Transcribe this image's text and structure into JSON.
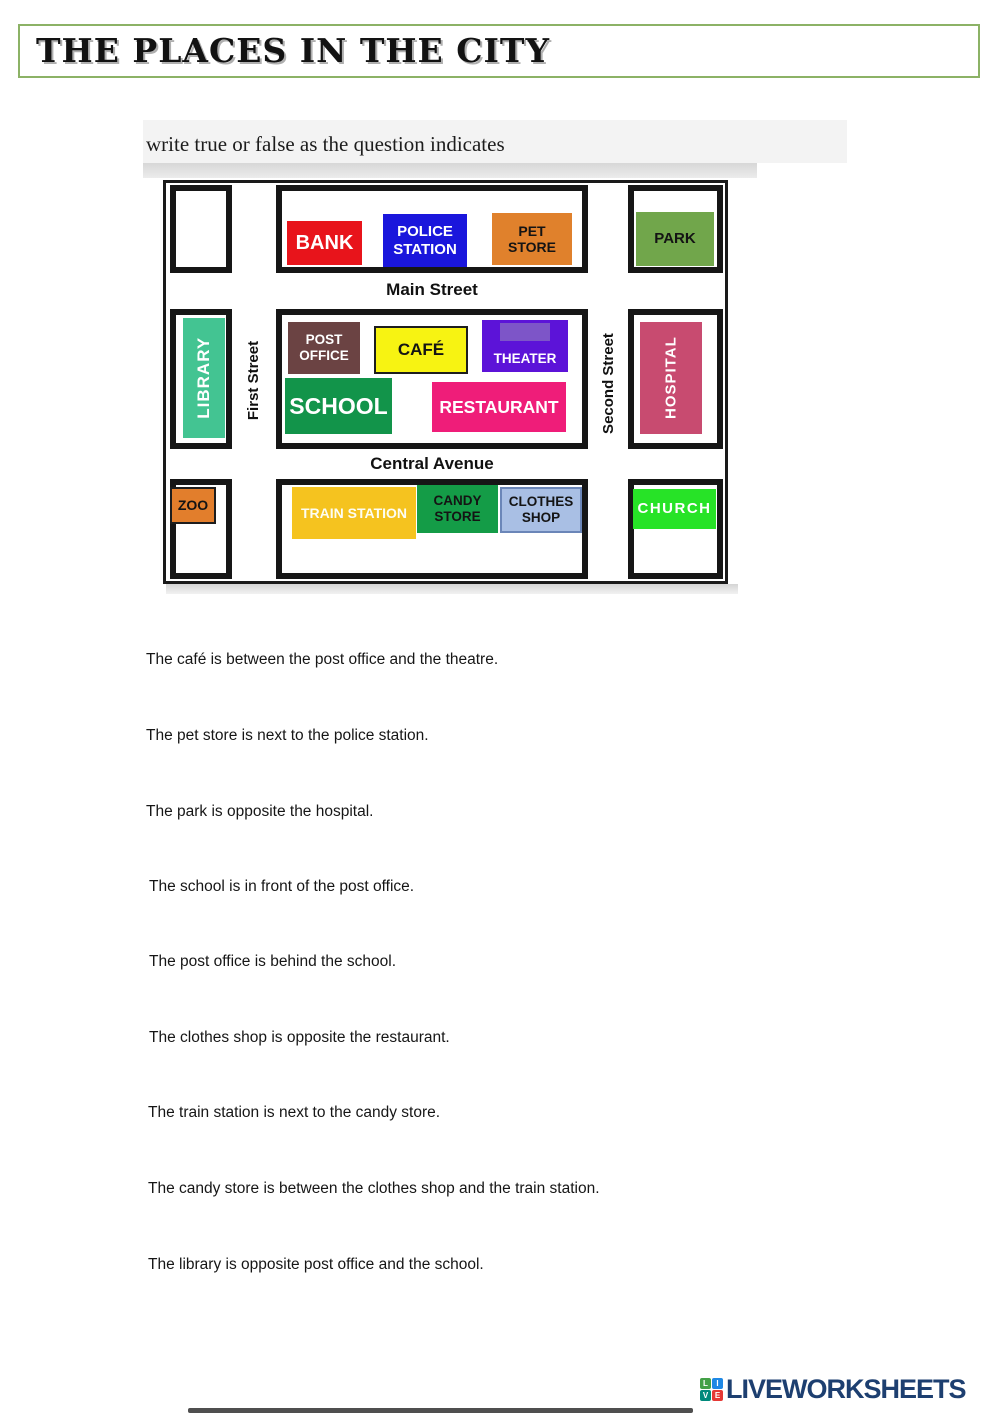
{
  "page": {
    "title": "THE PLACES IN THE CITY",
    "instruction": "write true or false as the question indicates"
  },
  "map": {
    "streets": {
      "main": "Main Street",
      "central": "Central Avenue",
      "first": "First Street",
      "second": "Second Street"
    },
    "buildings": {
      "bank": {
        "label": "BANK",
        "color": "#e8141b"
      },
      "police_station": {
        "label": "POLICE STATION",
        "color": "#1a16dc"
      },
      "pet_store": {
        "label": "PET STORE",
        "color": "#e0812c"
      },
      "park": {
        "label": "PARK",
        "color": "#71a64b"
      },
      "library": {
        "label": "LIBRARY",
        "color": "#43c492"
      },
      "post_office": {
        "label": "POST OFFICE",
        "color": "#6b4343"
      },
      "cafe": {
        "label": "CAFÉ",
        "color": "#f7f312"
      },
      "theater": {
        "label": "THEATER",
        "color": "#5c13d8",
        "decor_color": "#7d55c8"
      },
      "school": {
        "label": "SCHOOL",
        "color": "#12944a"
      },
      "restaurant": {
        "label": "RESTAURANT",
        "color": "#ef1d79"
      },
      "hospital": {
        "label": "HOSPITAL",
        "color": "#c84b70"
      },
      "zoo": {
        "label": "ZOO",
        "color": "#e27e2c"
      },
      "train_station": {
        "label": "TRAIN STATION",
        "color": "#f5c31f"
      },
      "candy_store": {
        "label": "CANDY STORE",
        "color": "#149c47"
      },
      "clothes_shop": {
        "label": "CLOTHES SHOP",
        "color": "#a9bfe4"
      },
      "church": {
        "label": "CHURCH",
        "color": "#27e327"
      }
    }
  },
  "questions": [
    "The café is between the post office and the theatre.",
    "The pet store is next to the police station.",
    "The park is opposite the hospital.",
    "The school is in front of the post office.",
    "The post office is behind the school.",
    "The clothes shop is opposite the restaurant.",
    "The train station is next to the candy store.",
    "The candy store is between the clothes shop and the train station.",
    "The library is opposite post office and the school."
  ],
  "footer": {
    "brand": "LIVEWORKSHEETS",
    "brand_color": "#1d3f70",
    "logo_letters": [
      "L",
      "I",
      "V",
      "E"
    ],
    "title_border_color": "#8cb266"
  }
}
